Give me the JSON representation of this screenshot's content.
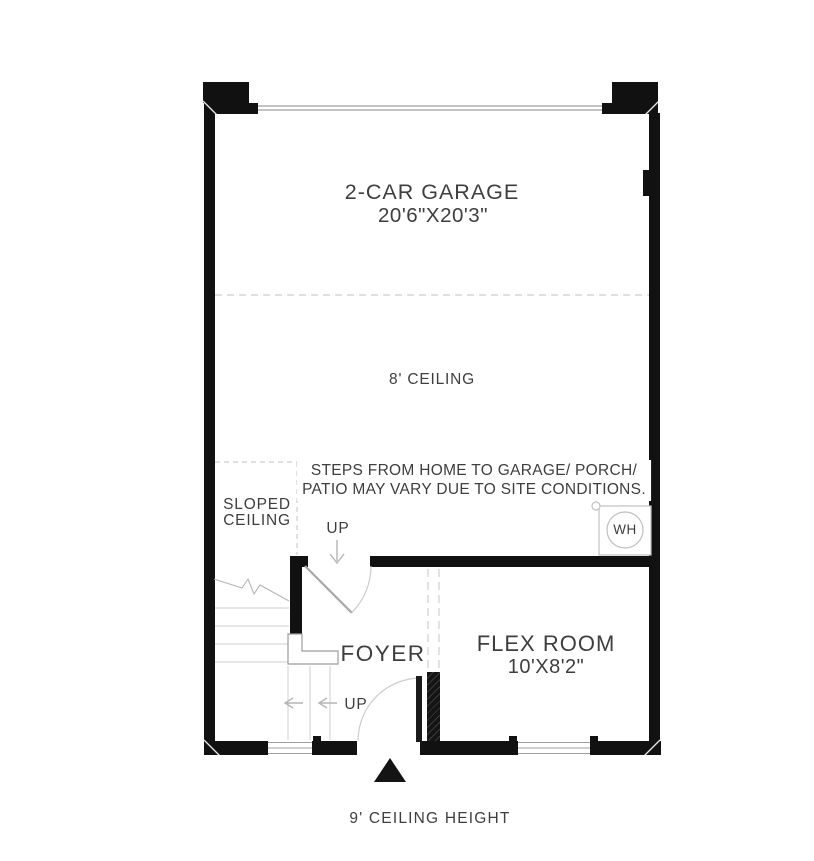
{
  "colors": {
    "wall": "#111111",
    "text": "#3e3e3e",
    "line_light": "#cccccc",
    "line_mid": "#9f9f9f",
    "bg": "#ffffff"
  },
  "plan": {
    "rooms": {
      "garage": {
        "label": "2-CAR GARAGE",
        "dimensions": "20'6\"X20'3\""
      },
      "flex_room": {
        "label": "FLEX ROOM",
        "dimensions": "10'X8'2\""
      },
      "foyer": {
        "label": "FOYER"
      }
    },
    "annotations": {
      "garage_ceiling": "8' CEILING",
      "sloped_ceiling": {
        "line1": "SLOPED",
        "line2": "CEILING"
      },
      "site_note": {
        "line1": "STEPS FROM HOME TO GARAGE/ PORCH/",
        "line2": "PATIO MAY VARY DUE TO SITE CONDITIONS."
      },
      "stairs_up": "UP",
      "entry_up": "UP",
      "water_heater": "WH",
      "footer": "9' CEILING HEIGHT"
    }
  }
}
